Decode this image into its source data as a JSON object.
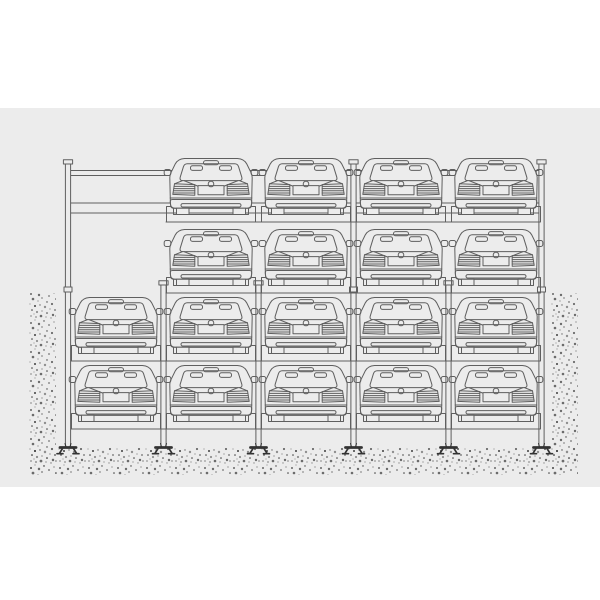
{
  "scene": {
    "description": "Elevation drawing of a four-level puzzle parking system with cars shown in rear view",
    "car_count": 18,
    "colors": {
      "background": "#ffffff",
      "panel": "#ececec",
      "line": "#5f5f5f",
      "dark": "#333333",
      "stipple_dark": "#3f3f3f",
      "stipple_mid": "#6b6b6b",
      "stipple_light": "#8f8f8f"
    },
    "panel": {
      "x": 0,
      "y": 108,
      "width": 600,
      "height": 379
    },
    "ground": {
      "left_strip": {
        "x": 28,
        "y": 293,
        "width": 28,
        "height": 182
      },
      "right_strip": {
        "x": 551,
        "y": 293,
        "width": 27,
        "height": 182
      },
      "bottom_band": {
        "x": 28,
        "y": 448,
        "width": 550,
        "height": 27
      }
    },
    "beams": [
      {
        "y": 170.5,
        "x1": 68,
        "x2": 541
      },
      {
        "y": 175.5,
        "x1": 68,
        "x2": 541
      },
      {
        "y": 203.0,
        "x1": 68,
        "x2": 541
      },
      {
        "y": 213.0,
        "x1": 68,
        "x2": 541
      }
    ],
    "columns": [
      {
        "x": 68.0,
        "top": 164,
        "full": true
      },
      {
        "x": 163.5,
        "top": 285,
        "full": false
      },
      {
        "x": 258.5,
        "top": 285,
        "full": false
      },
      {
        "x": 353.5,
        "top": 164,
        "full": true
      },
      {
        "x": 448.5,
        "top": 285,
        "full": false
      },
      {
        "x": 541.5,
        "top": 164,
        "full": true
      }
    ],
    "column_bottom": 447,
    "splice_y": 287,
    "bay_centers": [
      116,
      211,
      306,
      401,
      496
    ],
    "levels": [
      {
        "name": "level-4-top",
        "deck_y": 215,
        "occupied_bays": [
          1,
          2,
          3,
          4
        ],
        "band": [
          166,
          540
        ]
      },
      {
        "name": "level-3",
        "deck_y": 286,
        "occupied_bays": [
          1,
          2,
          3,
          4
        ],
        "band": [
          166,
          540
        ]
      },
      {
        "name": "level-2-pit-upper",
        "deck_y": 354,
        "occupied_bays": [
          0,
          1,
          2,
          3,
          4
        ],
        "band": [
          71,
          540
        ]
      },
      {
        "name": "level-1-pit-lower",
        "deck_y": 422,
        "occupied_bays": [
          0,
          1,
          2,
          3,
          4
        ],
        "band": [
          71,
          540
        ]
      }
    ],
    "car": {
      "body_width": 82,
      "total_height": 57
    }
  }
}
